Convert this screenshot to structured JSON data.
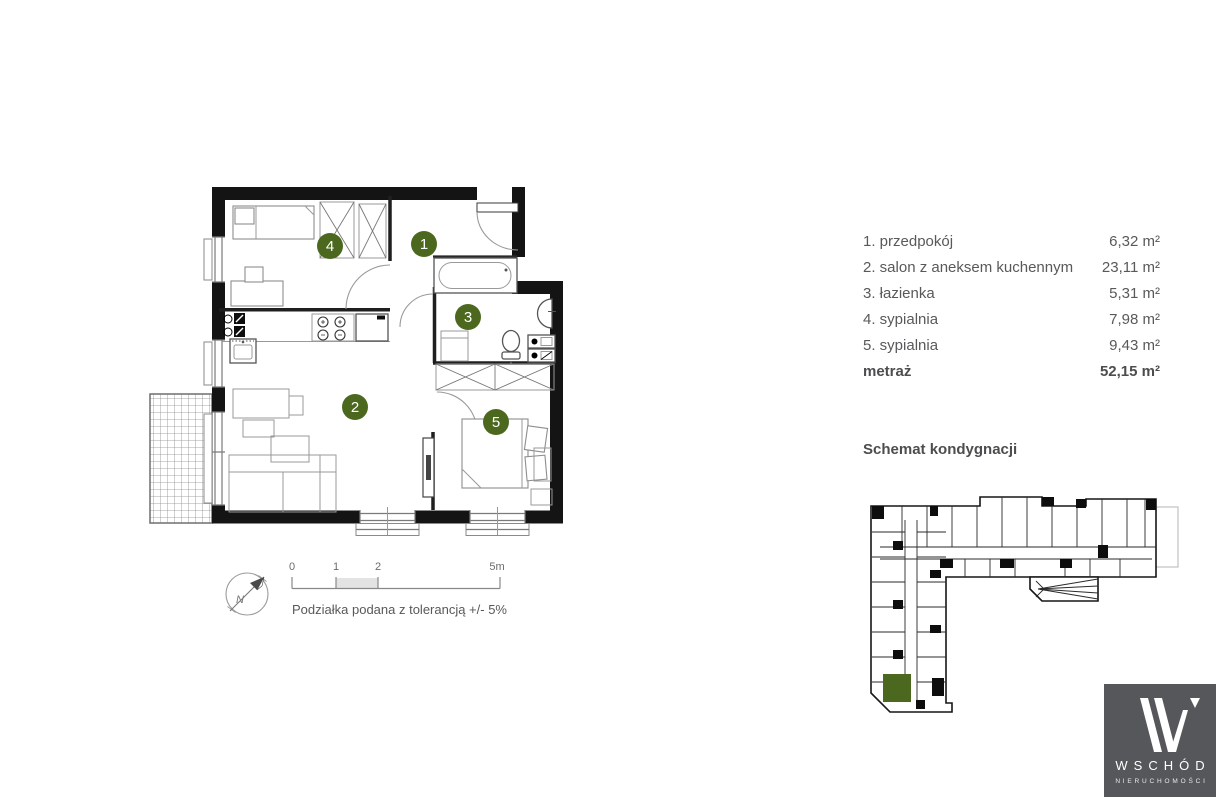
{
  "legend": {
    "rows": [
      {
        "label": "1. przedpokój",
        "area": "6,32 m²"
      },
      {
        "label": "2. salon z aneksem kuchennym",
        "area": "23,11 m²"
      },
      {
        "label": "3. łazienka",
        "area": "5,31 m²"
      },
      {
        "label": "4. sypialnia",
        "area": "7,98 m²"
      },
      {
        "label": "5. sypialnia",
        "area": "9,43 m²"
      }
    ],
    "total_label": "metraż",
    "total_area": "52,15 m²"
  },
  "rooms": {
    "r1": "1",
    "r2": "2",
    "r3": "3",
    "r4": "4",
    "r5": "5"
  },
  "scale_bar": {
    "ticks": [
      "0",
      "1",
      "2",
      "5m"
    ],
    "note": "Podziałka podana z tolerancją +/- 5%"
  },
  "compass": {
    "north_label": "N"
  },
  "schematic_title": "Schemat kondygnacji",
  "logo": {
    "brand": "WSCHÓD",
    "subbrand": "NIERUCHOMOŚCI"
  },
  "colors": {
    "accent_green": "#4c681f",
    "text_gray": "#58595b",
    "logo_background": "#56575a",
    "wall_black": "#141414"
  }
}
